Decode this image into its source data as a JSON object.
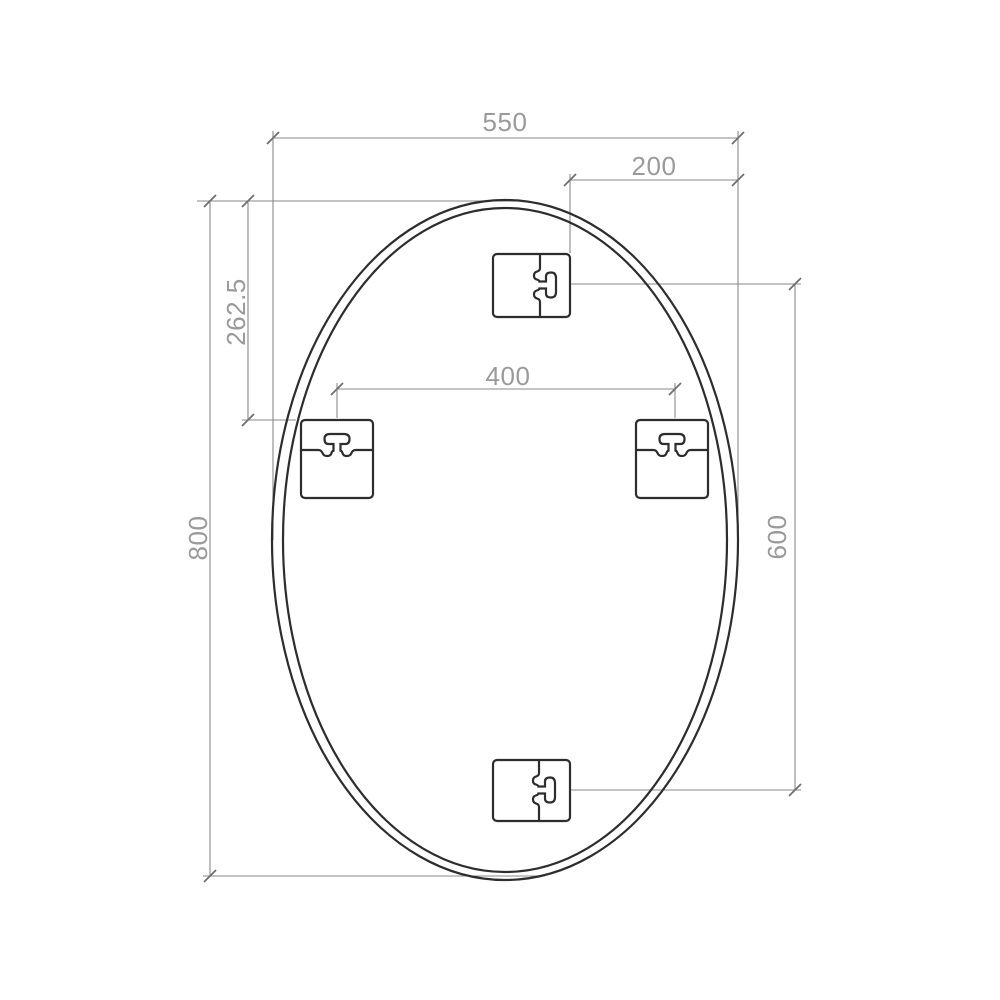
{
  "drawing": {
    "type": "technical-dimension-drawing",
    "subject": "oval mirror with four keyhole mounting brackets",
    "dimensions": {
      "overall_width": "550",
      "top_bracket_to_right_edge": "200",
      "top_edge_to_side_brackets": "262.5",
      "side_bracket_spacing": "400",
      "overall_height": "800",
      "top_to_bottom_bracket_spacing": "600"
    },
    "colors": {
      "background": "#ffffff",
      "outline": "#2d2d2d",
      "dimension_line": "#8a8a8a",
      "dimension_text": "#9a9a9a"
    }
  }
}
